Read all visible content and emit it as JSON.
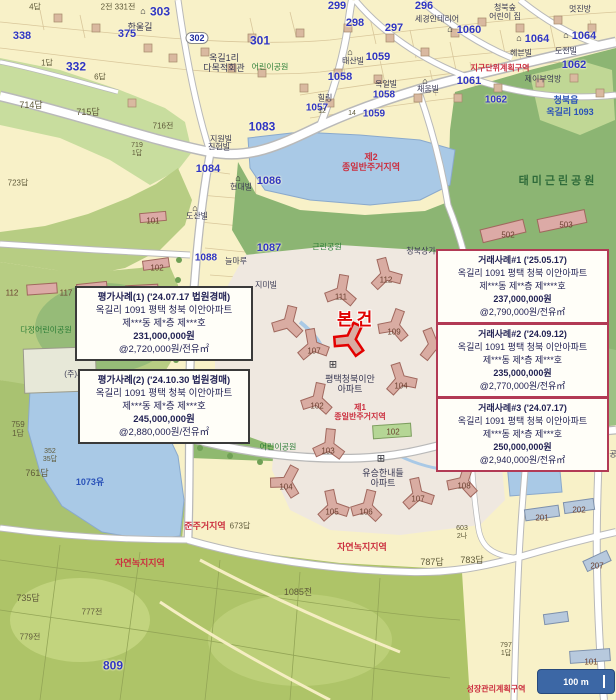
{
  "subject": {
    "label": "본건"
  },
  "scale_bar": {
    "label": "100 m"
  },
  "colors": {
    "parcel_cream": "#f8f1c8",
    "park_green": "#8cb573",
    "field_green": "#c8dd9e",
    "water_blue": "#a9c9e6",
    "road_white": "#ffffff",
    "building_tan": "#d9aca2",
    "subject_red": "#e00000",
    "transaction_box_border": "#b23a55",
    "appraisal_box_border": "#3a3a3a",
    "scalebar_blue": "#3c67a5"
  },
  "boxes": {
    "appraisal": [
      {
        "title": "평가사례(1) ('24.07.17 법원경매)",
        "address": "옥길리 1091 평택 청북 이안아파트",
        "unit": "제***동 제*층 제***호",
        "price": "231,000,000원",
        "unit_price": "@2,720,000원/전유㎡"
      },
      {
        "title": "평가사례(2) ('24.10.30 법원경매)",
        "address": "옥길리 1091 평택 청북 이안아파트",
        "unit": "제***동 제*층 제***호",
        "price": "245,000,000원",
        "unit_price": "@2,880,000원/전유㎡"
      }
    ],
    "transaction": [
      {
        "title": "거래사례#1 ('25.05.17)",
        "address": "옥길리 1091 평택 청북 이안아파트",
        "unit": "제***동 제**층 제****호",
        "price": "237,000,000원",
        "unit_price": "@2,790,000원/전유㎡"
      },
      {
        "title": "거래사례#2 ('24.09.12)",
        "address": "옥길리 1091 평택 청북 이안아파트",
        "unit": "제***동 제*층 제***호",
        "price": "235,000,000원",
        "unit_price": "@2,770,000원/전유㎡"
      },
      {
        "title": "거래사례#3 ('24.07.17)",
        "address": "옥길리 1091 평택 청북 이안아파트",
        "unit": "제***동 제*층 제***호",
        "price": "250,000,000원",
        "unit_price": "@2,940,000원/전유㎡"
      }
    ]
  },
  "map_labels": [
    {
      "t": "2전 331전",
      "x": 118,
      "y": 8,
      "cls": "ps",
      "fs": 8
    },
    {
      "t": "⌂",
      "x": 143,
      "y": 11,
      "cls": "icon",
      "fs": 9
    },
    {
      "t": "303",
      "x": 160,
      "y": 12,
      "cls": "pb",
      "fs": 12
    },
    {
      "t": "한울길",
      "x": 140,
      "y": 27,
      "cls": "bn",
      "fs": 9
    },
    {
      "t": "375",
      "x": 127,
      "y": 34,
      "cls": "pb",
      "fs": 11
    },
    {
      "t": "302",
      "x": 197,
      "y": 38,
      "cls": "pill",
      "fs": 9
    },
    {
      "t": "301",
      "x": 260,
      "y": 41,
      "cls": "pb",
      "fs": 12
    },
    {
      "t": "4답",
      "x": 35,
      "y": 8,
      "cls": "ps",
      "fs": 8
    },
    {
      "t": "338",
      "x": 22,
      "y": 36,
      "cls": "pb",
      "fs": 11
    },
    {
      "t": "1답",
      "x": 47,
      "y": 64,
      "cls": "ps",
      "fs": 8
    },
    {
      "t": "332",
      "x": 76,
      "y": 67,
      "cls": "pb",
      "fs": 12
    },
    {
      "t": "6답",
      "x": 100,
      "y": 78,
      "cls": "ps",
      "fs": 8
    },
    {
      "t": "옥길1리\n다목적회관",
      "x": 224,
      "y": 63,
      "cls": "bn",
      "fs": 9
    },
    {
      "t": "어린이공원",
      "x": 270,
      "y": 68,
      "cls": "gr",
      "fs": 8
    },
    {
      "t": "714답",
      "x": 31,
      "y": 105,
      "cls": "ps",
      "fs": 9
    },
    {
      "t": "715답",
      "x": 88,
      "y": 112,
      "cls": "ps",
      "fs": 9
    },
    {
      "t": "716전",
      "x": 163,
      "y": 127,
      "cls": "ps",
      "fs": 8
    },
    {
      "t": "1083",
      "x": 262,
      "y": 127,
      "cls": "pb",
      "fs": 12
    },
    {
      "t": "지원빌",
      "x": 221,
      "y": 140,
      "cls": "bn",
      "fs": 8
    },
    {
      "t": "719\n1답",
      "x": 137,
      "y": 150,
      "cls": "ps",
      "fs": 7
    },
    {
      "t": "723답",
      "x": 18,
      "y": 184,
      "cls": "ps",
      "fs": 8
    },
    {
      "t": "진헌빌",
      "x": 219,
      "y": 148,
      "cls": "bn",
      "fs": 8
    },
    {
      "t": "1084",
      "x": 208,
      "y": 169,
      "cls": "pb",
      "fs": 11
    },
    {
      "t": "⌂",
      "x": 238,
      "y": 178,
      "cls": "icon",
      "fs": 9
    },
    {
      "t": "현대빌",
      "x": 241,
      "y": 188,
      "cls": "bn",
      "fs": 8
    },
    {
      "t": "1086",
      "x": 269,
      "y": 181,
      "cls": "pb",
      "fs": 11
    },
    {
      "t": "⌂",
      "x": 195,
      "y": 208,
      "cls": "icon",
      "fs": 9
    },
    {
      "t": "도산빌",
      "x": 197,
      "y": 217,
      "cls": "bn",
      "fs": 8
    },
    {
      "t": "1087",
      "x": 269,
      "y": 248,
      "cls": "pb",
      "fs": 11
    },
    {
      "t": "1088",
      "x": 206,
      "y": 258,
      "cls": "pb",
      "fs": 10
    },
    {
      "t": "늘마루",
      "x": 236,
      "y": 262,
      "cls": "bn",
      "fs": 8
    },
    {
      "t": "지미빌",
      "x": 266,
      "y": 286,
      "cls": "bn",
      "fs": 8
    },
    {
      "t": "101",
      "x": 153,
      "y": 222,
      "cls": "num",
      "fs": 8
    },
    {
      "t": "102",
      "x": 157,
      "y": 269,
      "cls": "num",
      "fs": 8
    },
    {
      "t": "299",
      "x": 337,
      "y": 6,
      "cls": "pb",
      "fs": 11
    },
    {
      "t": "298",
      "x": 355,
      "y": 23,
      "cls": "pb",
      "fs": 11
    },
    {
      "t": "297",
      "x": 394,
      "y": 28,
      "cls": "pb",
      "fs": 11
    },
    {
      "t": "296",
      "x": 424,
      "y": 6,
      "cls": "pb",
      "fs": 11
    },
    {
      "t": "세경인테리어",
      "x": 437,
      "y": 20,
      "cls": "bn",
      "fs": 8
    },
    {
      "t": "청북숲\n어린이 집",
      "x": 505,
      "y": 13,
      "cls": "bn",
      "fs": 8
    },
    {
      "t": "멋진방",
      "x": 580,
      "y": 10,
      "cls": "bn",
      "fs": 8
    },
    {
      "t": "⌂",
      "x": 450,
      "y": 29,
      "cls": "icon",
      "fs": 9
    },
    {
      "t": "1060",
      "x": 469,
      "y": 30,
      "cls": "pb",
      "fs": 11
    },
    {
      "t": "⌂",
      "x": 519,
      "y": 38,
      "cls": "icon",
      "fs": 9
    },
    {
      "t": "1064",
      "x": 537,
      "y": 39,
      "cls": "pb",
      "fs": 11
    },
    {
      "t": "⌂",
      "x": 566,
      "y": 35,
      "cls": "icon",
      "fs": 9
    },
    {
      "t": "1064",
      "x": 584,
      "y": 36,
      "cls": "pb",
      "fs": 11
    },
    {
      "t": "⌂",
      "x": 350,
      "y": 52,
      "cls": "icon",
      "fs": 9
    },
    {
      "t": "태산빌",
      "x": 353,
      "y": 62,
      "cls": "bn",
      "fs": 8
    },
    {
      "t": "1059",
      "x": 378,
      "y": 57,
      "cls": "pb",
      "fs": 11
    },
    {
      "t": "헤븐빌",
      "x": 521,
      "y": 54,
      "cls": "bn",
      "fs": 8
    },
    {
      "t": "도전빌",
      "x": 566,
      "y": 52,
      "cls": "bn",
      "fs": 8
    },
    {
      "t": "1058",
      "x": 340,
      "y": 77,
      "cls": "pb",
      "fs": 11
    },
    {
      "t": "옥일빌",
      "x": 386,
      "y": 85,
      "cls": "bn",
      "fs": 8
    },
    {
      "t": "1061",
      "x": 469,
      "y": 81,
      "cls": "pb",
      "fs": 11
    },
    {
      "t": "1062",
      "x": 574,
      "y": 65,
      "cls": "pb",
      "fs": 11
    },
    {
      "t": "지구단위계획구역",
      "x": 500,
      "y": 69,
      "cls": "rd",
      "fs": 8
    },
    {
      "t": "제이부엌방",
      "x": 543,
      "y": 80,
      "cls": "bn",
      "fs": 8
    },
    {
      "t": "1058",
      "x": 384,
      "y": 95,
      "cls": "pb",
      "fs": 10
    },
    {
      "t": "⌂",
      "x": 425,
      "y": 81,
      "cls": "icon",
      "fs": 9
    },
    {
      "t": "채움빌",
      "x": 428,
      "y": 90,
      "cls": "bn",
      "fs": 8
    },
    {
      "t": "힐링",
      "x": 325,
      "y": 99,
      "cls": "bn",
      "fs": 8
    },
    {
      "t": "1057",
      "x": 317,
      "y": 108,
      "cls": "pb",
      "fs": 10
    },
    {
      "t": "1062",
      "x": 496,
      "y": 100,
      "cls": "pb",
      "fs": 10
    },
    {
      "t": "12",
      "x": 322,
      "y": 112,
      "cls": "ps",
      "fs": 7
    },
    {
      "t": "14",
      "x": 352,
      "y": 114,
      "cls": "ps",
      "fs": 7
    },
    {
      "t": "1059",
      "x": 374,
      "y": 114,
      "cls": "pb",
      "fs": 10
    },
    {
      "t": "청북읍",
      "x": 566,
      "y": 100,
      "cls": "wl",
      "fs": 9
    },
    {
      "t": "옥길리 1093",
      "x": 570,
      "y": 112,
      "cls": "wl",
      "fs": 9
    },
    {
      "t": "제2\n종일반주거지역",
      "x": 371,
      "y": 162,
      "cls": "rd",
      "fs": 9
    },
    {
      "t": "태미근린공원",
      "x": 558,
      "y": 181,
      "cls": "grd",
      "fs": 11
    },
    {
      "t": "112",
      "x": 12,
      "y": 294,
      "cls": "num",
      "fs": 8
    },
    {
      "t": "117",
      "x": 66,
      "y": 294,
      "cls": "num",
      "fs": 8
    },
    {
      "t": "다정어린이공원",
      "x": 46,
      "y": 331,
      "cls": "gr",
      "fs": 8
    },
    {
      "t": "(주)세웰",
      "x": 78,
      "y": 375,
      "cls": "bn",
      "fs": 8
    },
    {
      "t": "759\n1답",
      "x": 18,
      "y": 430,
      "cls": "ps",
      "fs": 8
    },
    {
      "t": "352\n35답",
      "x": 50,
      "y": 456,
      "cls": "ps",
      "fs": 7
    },
    {
      "t": "761답",
      "x": 37,
      "y": 473,
      "cls": "ps",
      "fs": 9
    },
    {
      "t": "1073유",
      "x": 90,
      "y": 482,
      "cls": "wl",
      "fs": 9
    },
    {
      "t": "근린체육공원",
      "x": 214,
      "y": 437,
      "cls": "gr",
      "fs": 8
    },
    {
      "t": "어린이공원",
      "x": 278,
      "y": 448,
      "cls": "gr",
      "fs": 8
    },
    {
      "t": "준주거지역",
      "x": 205,
      "y": 526,
      "cls": "rd",
      "fs": 9
    },
    {
      "t": "673답",
      "x": 240,
      "y": 527,
      "cls": "ps",
      "fs": 8
    },
    {
      "t": "자연녹지지역",
      "x": 140,
      "y": 563,
      "cls": "rd",
      "fs": 9
    },
    {
      "t": "자연녹지지역",
      "x": 362,
      "y": 547,
      "cls": "rd",
      "fs": 9
    },
    {
      "t": "근린공원",
      "x": 327,
      "y": 248,
      "cls": "gr",
      "fs": 8
    },
    {
      "t": "청북상가",
      "x": 421,
      "y": 252,
      "cls": "bn",
      "fs": 8
    },
    {
      "t": "112",
      "x": 386,
      "y": 281,
      "cls": "num",
      "fs": 8
    },
    {
      "t": "111",
      "x": 341,
      "y": 298,
      "cls": "num",
      "fs": 8
    },
    {
      "t": "109",
      "x": 394,
      "y": 333,
      "cls": "num",
      "fs": 8
    },
    {
      "t": "107",
      "x": 314,
      "y": 352,
      "cls": "num",
      "fs": 8
    },
    {
      "t": "104",
      "x": 401,
      "y": 387,
      "cls": "num",
      "fs": 8
    },
    {
      "t": "102",
      "x": 317,
      "y": 407,
      "cls": "num",
      "fs": 8
    },
    {
      "t": "⊞",
      "x": 333,
      "y": 365,
      "cls": "icon",
      "fs": 10
    },
    {
      "t": "평택청북이안\n아파트",
      "x": 350,
      "y": 384,
      "cls": "bn",
      "fs": 9
    },
    {
      "t": "제1\n종일반주거지역",
      "x": 360,
      "y": 413,
      "cls": "rd",
      "fs": 8
    },
    {
      "t": "1092",
      "x": 468,
      "y": 432,
      "cls": "pb",
      "fs": 10
    },
    {
      "t": "⊞",
      "x": 381,
      "y": 459,
      "cls": "icon",
      "fs": 10
    },
    {
      "t": "유승한내들\n아파트",
      "x": 383,
      "y": 478,
      "cls": "bn",
      "fs": 9
    },
    {
      "t": "메트로스위첸",
      "x": 472,
      "y": 469,
      "cls": "bn",
      "fs": 8
    },
    {
      "t": "103",
      "x": 328,
      "y": 452,
      "cls": "num",
      "fs": 8
    },
    {
      "t": "102",
      "x": 393,
      "y": 433,
      "cls": "num",
      "fs": 8
    },
    {
      "t": "105",
      "x": 332,
      "y": 513,
      "cls": "num",
      "fs": 8
    },
    {
      "t": "106",
      "x": 366,
      "y": 513,
      "cls": "num",
      "fs": 8
    },
    {
      "t": "107",
      "x": 418,
      "y": 500,
      "cls": "num",
      "fs": 8
    },
    {
      "t": "108",
      "x": 464,
      "y": 487,
      "cls": "num",
      "fs": 8
    },
    {
      "t": "104",
      "x": 286,
      "y": 488,
      "cls": "num",
      "fs": 8
    },
    {
      "t": "502",
      "x": 508,
      "y": 236,
      "cls": "num",
      "fs": 8
    },
    {
      "t": "503",
      "x": 566,
      "y": 226,
      "cls": "num",
      "fs": 8
    },
    {
      "t": "603\n2나",
      "x": 462,
      "y": 533,
      "cls": "ps",
      "fs": 7
    },
    {
      "t": "787답",
      "x": 432,
      "y": 562,
      "cls": "ps",
      "fs": 9
    },
    {
      "t": "783답",
      "x": 472,
      "y": 560,
      "cls": "ps",
      "fs": 9
    },
    {
      "t": "201",
      "x": 542,
      "y": 519,
      "cls": "num",
      "fs": 8
    },
    {
      "t": "202",
      "x": 579,
      "y": 511,
      "cls": "num",
      "fs": 8
    },
    {
      "t": "207",
      "x": 597,
      "y": 567,
      "cls": "num",
      "fs": 8
    },
    {
      "t": "101",
      "x": 591,
      "y": 663,
      "cls": "num",
      "fs": 8
    },
    {
      "t": "청북체육공원",
      "x": 602,
      "y": 455,
      "cls": "bn",
      "fs": 8
    },
    {
      "t": "809",
      "x": 113,
      "y": 666,
      "cls": "pb",
      "fs": 12
    },
    {
      "t": "735답",
      "x": 28,
      "y": 598,
      "cls": "ps",
      "fs": 9
    },
    {
      "t": "777전",
      "x": 92,
      "y": 613,
      "cls": "ps",
      "fs": 8
    },
    {
      "t": "779전",
      "x": 30,
      "y": 638,
      "cls": "ps",
      "fs": 8
    },
    {
      "t": "1085전",
      "x": 298,
      "y": 592,
      "cls": "ps",
      "fs": 9
    },
    {
      "t": "797\n1답",
      "x": 506,
      "y": 650,
      "cls": "ps",
      "fs": 7
    },
    {
      "t": "성장관리계획구역",
      "x": 496,
      "y": 690,
      "cls": "rd",
      "fs": 8
    }
  ],
  "buildings": [
    {
      "type": "apt",
      "x": 386,
      "y": 276,
      "r": -15
    },
    {
      "type": "apt",
      "x": 341,
      "y": 293,
      "r": 10
    },
    {
      "type": "apt",
      "x": 394,
      "y": 327,
      "r": 20
    },
    {
      "type": "apt",
      "x": 313,
      "y": 347,
      "r": -10
    },
    {
      "type": "apt",
      "x": 288,
      "y": 324,
      "r": 14
    },
    {
      "type": "apt",
      "x": 401,
      "y": 381,
      "r": -18
    },
    {
      "type": "apt",
      "x": 317,
      "y": 401,
      "r": 12
    },
    {
      "type": "apt",
      "x": 434,
      "y": 346,
      "r": -22
    },
    {
      "type": "subject",
      "x": 350,
      "y": 341,
      "r": 25
    },
    {
      "type": "apt",
      "x": 329,
      "y": 447,
      "r": 6
    },
    {
      "type": "apt",
      "x": 333,
      "y": 508,
      "r": -12
    },
    {
      "type": "apt",
      "x": 367,
      "y": 508,
      "r": 14
    },
    {
      "type": "apt",
      "x": 418,
      "y": 496,
      "r": -12
    },
    {
      "type": "apt",
      "x": 463,
      "y": 483,
      "r": 18
    },
    {
      "type": "apt",
      "x": 286,
      "y": 483,
      "r": 28
    },
    {
      "type": "green",
      "x": 392,
      "y": 431,
      "w": 38,
      "h": 13,
      "r": -4
    },
    {
      "type": "pink",
      "x": 503,
      "y": 231,
      "w": 44,
      "h": 13,
      "r": -14
    },
    {
      "type": "pink",
      "x": 562,
      "y": 221,
      "w": 48,
      "h": 13,
      "r": -12
    },
    {
      "type": "blue",
      "x": 542,
      "y": 513,
      "w": 34,
      "h": 11,
      "r": -8
    },
    {
      "type": "blue",
      "x": 579,
      "y": 506,
      "w": 30,
      "h": 11,
      "r": -8
    },
    {
      "type": "blue",
      "x": 597,
      "y": 561,
      "w": 26,
      "h": 11,
      "r": -25
    },
    {
      "type": "blue",
      "x": 590,
      "y": 656,
      "w": 40,
      "h": 12,
      "r": -4
    },
    {
      "type": "blue",
      "x": 556,
      "y": 618,
      "w": 24,
      "h": 10,
      "r": -8
    },
    {
      "type": "pink",
      "x": 153,
      "y": 217,
      "w": 26,
      "h": 9,
      "r": -5
    },
    {
      "type": "pink",
      "x": 156,
      "y": 264,
      "w": 26,
      "h": 9,
      "r": -8
    },
    {
      "type": "pink",
      "x": 42,
      "y": 289,
      "w": 30,
      "h": 10,
      "r": -4
    },
    {
      "type": "pink",
      "x": 92,
      "y": 288,
      "w": 30,
      "h": 10,
      "r": -6
    },
    {
      "type": "pink",
      "x": 142,
      "y": 290,
      "w": 32,
      "h": 10,
      "r": -3
    },
    {
      "type": "plant",
      "x": 60,
      "y": 370,
      "w": 72,
      "h": 44,
      "r": -2
    },
    {
      "type": "small",
      "x": 58,
      "y": 18
    },
    {
      "type": "small",
      "x": 96,
      "y": 28
    },
    {
      "type": "small",
      "x": 148,
      "y": 48
    },
    {
      "type": "small",
      "x": 205,
      "y": 52
    },
    {
      "type": "small",
      "x": 252,
      "y": 38
    },
    {
      "type": "small",
      "x": 300,
      "y": 33
    },
    {
      "type": "small",
      "x": 348,
      "y": 28
    },
    {
      "type": "small",
      "x": 390,
      "y": 38
    },
    {
      "type": "small",
      "x": 425,
      "y": 52
    },
    {
      "type": "small",
      "x": 455,
      "y": 33
    },
    {
      "type": "small",
      "x": 482,
      "y": 22
    },
    {
      "type": "small",
      "x": 520,
      "y": 28
    },
    {
      "type": "small",
      "x": 558,
      "y": 20
    },
    {
      "type": "small",
      "x": 592,
      "y": 28
    },
    {
      "type": "small",
      "x": 338,
      "y": 73
    },
    {
      "type": "small",
      "x": 378,
      "y": 79
    },
    {
      "type": "small",
      "x": 418,
      "y": 98
    },
    {
      "type": "small",
      "x": 458,
      "y": 98
    },
    {
      "type": "small",
      "x": 498,
      "y": 88
    },
    {
      "type": "small",
      "x": 540,
      "y": 83
    },
    {
      "type": "small",
      "x": 574,
      "y": 78
    },
    {
      "type": "small",
      "x": 600,
      "y": 93
    },
    {
      "type": "small",
      "x": 262,
      "y": 73
    },
    {
      "type": "small",
      "x": 232,
      "y": 68
    },
    {
      "type": "small",
      "x": 330,
      "y": 103
    },
    {
      "type": "small",
      "x": 304,
      "y": 88
    },
    {
      "type": "small",
      "x": 132,
      "y": 103
    },
    {
      "type": "small",
      "x": 173,
      "y": 58
    }
  ]
}
